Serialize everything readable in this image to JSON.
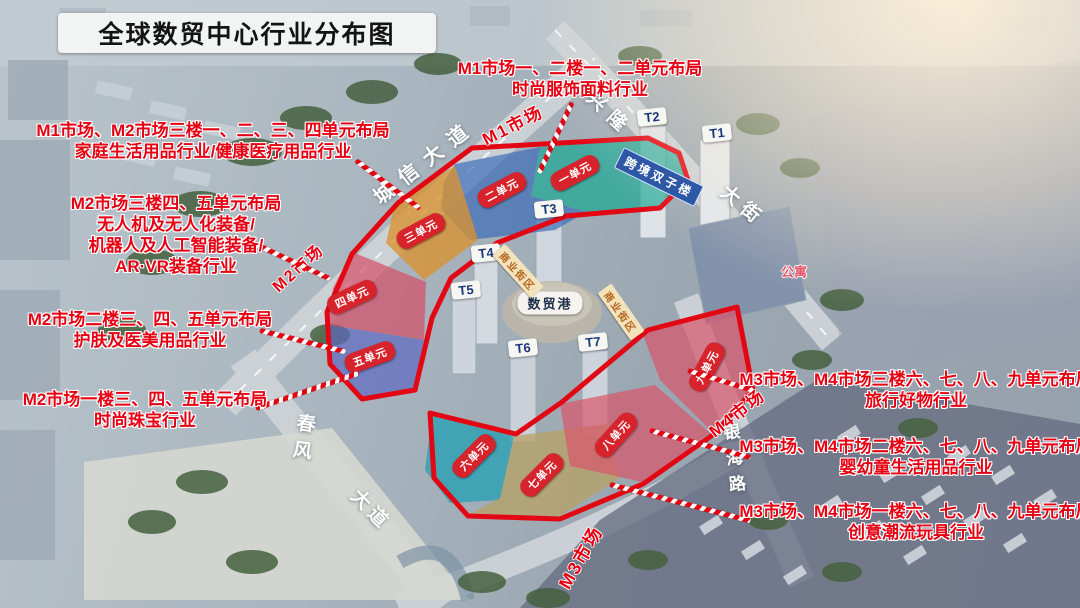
{
  "title": "全球数贸中心行业分布图",
  "palette": {
    "annotation_red": "#e60012",
    "zone_border_red": "#e30613",
    "unit_pill_red": "#d7232b",
    "unit1_teal": "#1fa796",
    "unit2_blue": "#3a6ab8",
    "unit3_orange": "#d8922f",
    "unit4_pink": "#d44f66",
    "unit5_violet": "#5c68c0",
    "unit6_cyan": "#27a0b4",
    "unit7_tan": "#b7a268",
    "unit89_rose": "#d8566b"
  },
  "annotations": [
    {
      "lines": [
        "M1市场一、二楼一、二单元布局",
        "时尚服饰面料行业"
      ]
    },
    {
      "lines": [
        "M1市场、M2市场三楼一、二、三、四单元布局",
        "家庭生活用品行业/健康医疗用品行业"
      ]
    },
    {
      "lines": [
        "M2市场三楼四、五单元布局",
        "无人机及无人化装备/",
        "机器人及人工智能装备/",
        "AR·VR装备行业"
      ]
    },
    {
      "lines": [
        "M2市场二楼三、四、五单元布局",
        "护肤及医美用品行业"
      ]
    },
    {
      "lines": [
        "M2市场一楼三、四、五单元布局",
        "时尚珠宝行业"
      ]
    },
    {
      "lines": [
        "M3市场、M4市场三楼六、七、八、九单元布局",
        "旅行好物行业"
      ]
    },
    {
      "lines": [
        "M3市场、M4市场二楼六、七、八、九单元布局",
        "婴幼童生活用品行业"
      ]
    },
    {
      "lines": [
        "M3市场、M4市场一楼六、七、八、九单元布局",
        "创意潮流玩具行业"
      ]
    }
  ],
  "roads": {
    "chengxin_avenue": "城信大道",
    "xinglong": "兴隆",
    "street": "大街",
    "chunfeng": "春风",
    "avenue": "大道",
    "yinhai_road": "银海路"
  },
  "markets": {
    "m1": "M1市场",
    "m2": "M2市场",
    "m3": "M3市场",
    "m4": "M4市场"
  },
  "buildings": {
    "t1": "T1",
    "t2": "T2",
    "t3": "T3",
    "t4": "T4",
    "t5": "T5",
    "t6": "T6",
    "t7": "T7",
    "shumao_port": "数贸港",
    "twin_towers": "跨境双子楼",
    "commercial_street": "商业街区",
    "apartment": "公寓"
  },
  "units": {
    "u1": "一单元",
    "u2": "二单元",
    "u3": "三单元",
    "u4": "四单元",
    "u5": "五单元",
    "u6": "六单元",
    "u7": "七单元",
    "u8": "八单元",
    "u9": "九单元"
  }
}
